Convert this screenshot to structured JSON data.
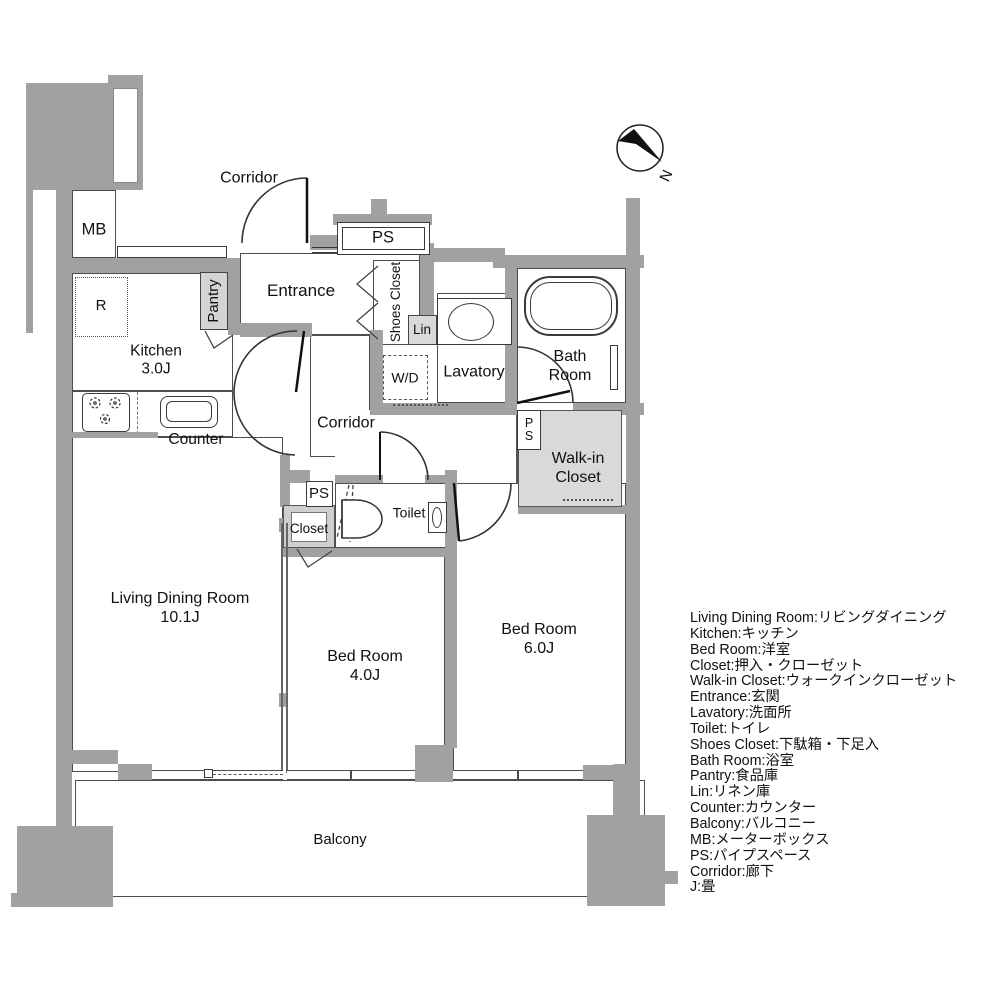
{
  "colors": {
    "wall": "#a1a1a1",
    "light_fill": "#d9d9d9",
    "outline": "#4d4d4d",
    "text": "#111111"
  },
  "labels": {
    "corridor_top": "Corridor",
    "mb": "MB",
    "ps_entrance": "PS",
    "entrance": "Entrance",
    "pantry": "Pantry",
    "shoes_closet": "Shoes Closet",
    "lin": "Lin",
    "fridge": "R",
    "kitchen_name": "Kitchen",
    "kitchen_size": "3.0J",
    "wd": "W/D",
    "lavatory": "Lavatory",
    "bath_line1": "Bath",
    "bath_line2": "Room",
    "counter": "Counter",
    "corridor_mid": "Corridor",
    "wic_line1": "Walk-in",
    "wic_line2": "Closet",
    "ps_wic_l1": "P",
    "ps_wic_l2": "S",
    "ps_closet": "PS",
    "closet": "Closet",
    "toilet": "Toilet",
    "ldr_name": "Living Dining Room",
    "ldr_size": "10.1J",
    "bed4_name": "Bed Room",
    "bed4_size": "4.0J",
    "bed6_name": "Bed Room",
    "bed6_size": "6.0J",
    "balcony": "Balcony",
    "compass_n": "N"
  },
  "legend": {
    "items": [
      "Living Dining Room:リビングダイニング",
      "Kitchen:キッチン",
      "Bed Room:洋室",
      "Closet:押入・クローゼット",
      "Walk-in Closet:ウォークインクローゼット",
      "Entrance:玄関",
      "Lavatory:洗面所",
      "Toilet:トイレ",
      "Shoes Closet:下駄箱・下足入",
      "Bath Room:浴室",
      "Pantry:食品庫",
      "Lin:リネン庫",
      "Counter:カウンター",
      "Balcony:バルコニー",
      "MB:メーターボックス",
      "PS:パイプスペース",
      "Corridor:廊下",
      "J:畳"
    ]
  }
}
